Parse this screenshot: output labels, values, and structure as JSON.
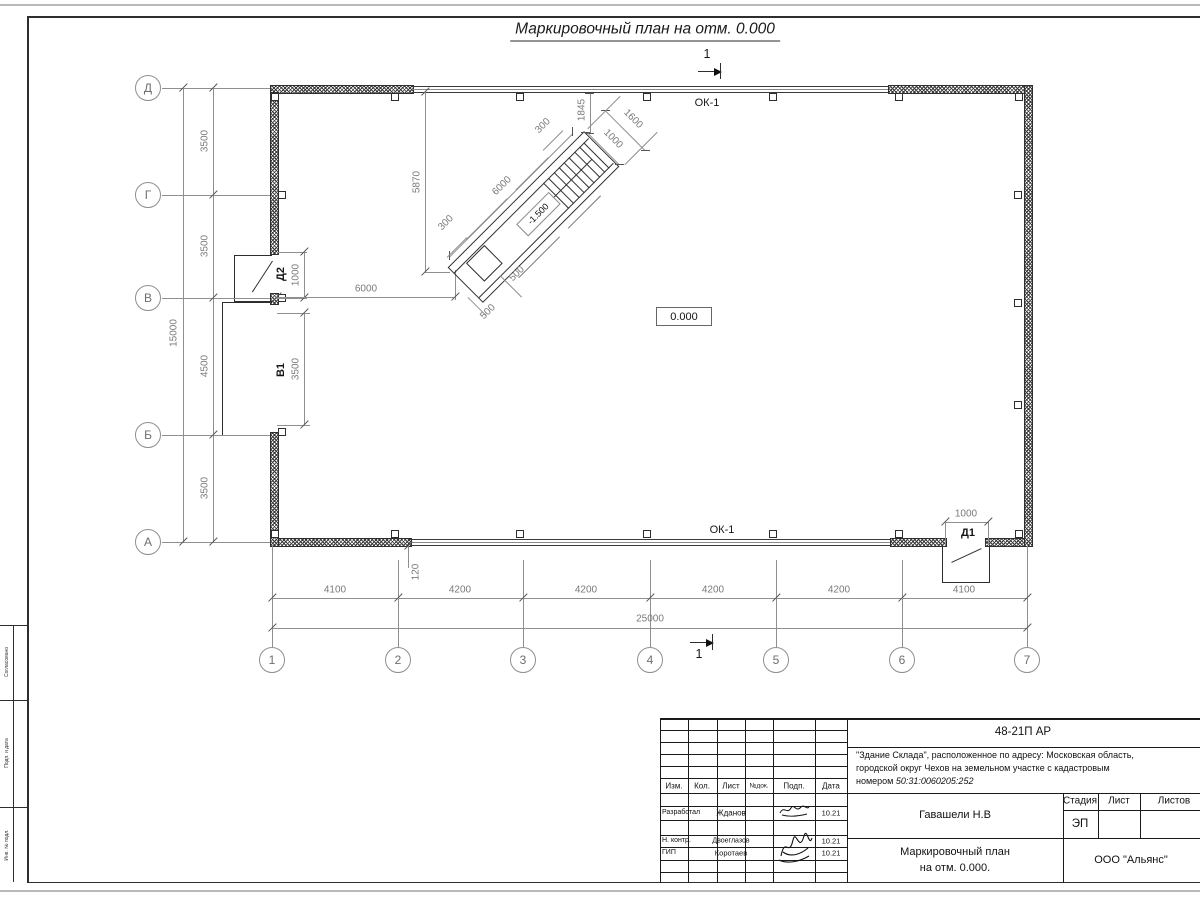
{
  "sheet": {
    "title": "Маркировочный план на отм. 0.000",
    "side_strip": {
      "top": "Согласовано",
      "middle": "Подп. и дата",
      "bottom": "Инв. № подл."
    }
  },
  "plan": {
    "level_mark": "0.000",
    "window_top": "ОК-1",
    "window_bottom": "ОК-1",
    "section_mark": "1",
    "axes": {
      "letters": [
        "Д",
        "Г",
        "В",
        "Б",
        "А"
      ],
      "numbers": [
        "1",
        "2",
        "3",
        "4",
        "5",
        "6",
        "7"
      ]
    },
    "dims": {
      "left": [
        "3500",
        "3500",
        "4500",
        "3500"
      ],
      "left_total": "15000",
      "bottom": [
        "4100",
        "4200",
        "4200",
        "4200",
        "4200",
        "4100"
      ],
      "bottom_total": "25000",
      "offset": "120",
      "interior": "6000"
    },
    "openings": {
      "d2_label": "Д2",
      "d2_width": "1000",
      "v1_label": "В1",
      "v1_width": "3500",
      "d1_label": "Д1",
      "d1_width": "1000"
    },
    "stair": {
      "level": "-1.500",
      "length": "6000",
      "height": "5870",
      "d1845": "1845",
      "d1600": "1600",
      "d1000": "1000",
      "d300a": "300",
      "d300b": "300",
      "d500a": "500",
      "d500b": "500"
    }
  },
  "title_block": {
    "doc_number": "48-21П АР",
    "description1": "\"Здание Склада\", расположенное по адресу: Московская область,",
    "description2": "городской округ Чехов на земельном участке с кадастровым",
    "description3": "номером ",
    "cadastral": "50:31:0060205:252",
    "cols": {
      "izm": "Изм.",
      "kol": "Кол.",
      "list": "Лист",
      "ndok": "№док.",
      "podp": "Подп.",
      "data": "Дата"
    },
    "rows": [
      {
        "role": "Разработал",
        "name": "Жданов",
        "date": "10.21"
      },
      {
        "role": "Н. контр.",
        "name": "Двоеглазов",
        "date": "10.21"
      },
      {
        "role": "ГИП",
        "name": "Коротаев",
        "date": "10.21"
      }
    ],
    "approver": "Гавашели Н.В",
    "stage_label": "Стадия",
    "list_label": "Лист",
    "listov_label": "Листов",
    "stage": "ЭП",
    "drawing_title1": "Маркировочный план",
    "drawing_title2": "на отм. 0.000.",
    "company": "ООО \"Альянс\""
  }
}
